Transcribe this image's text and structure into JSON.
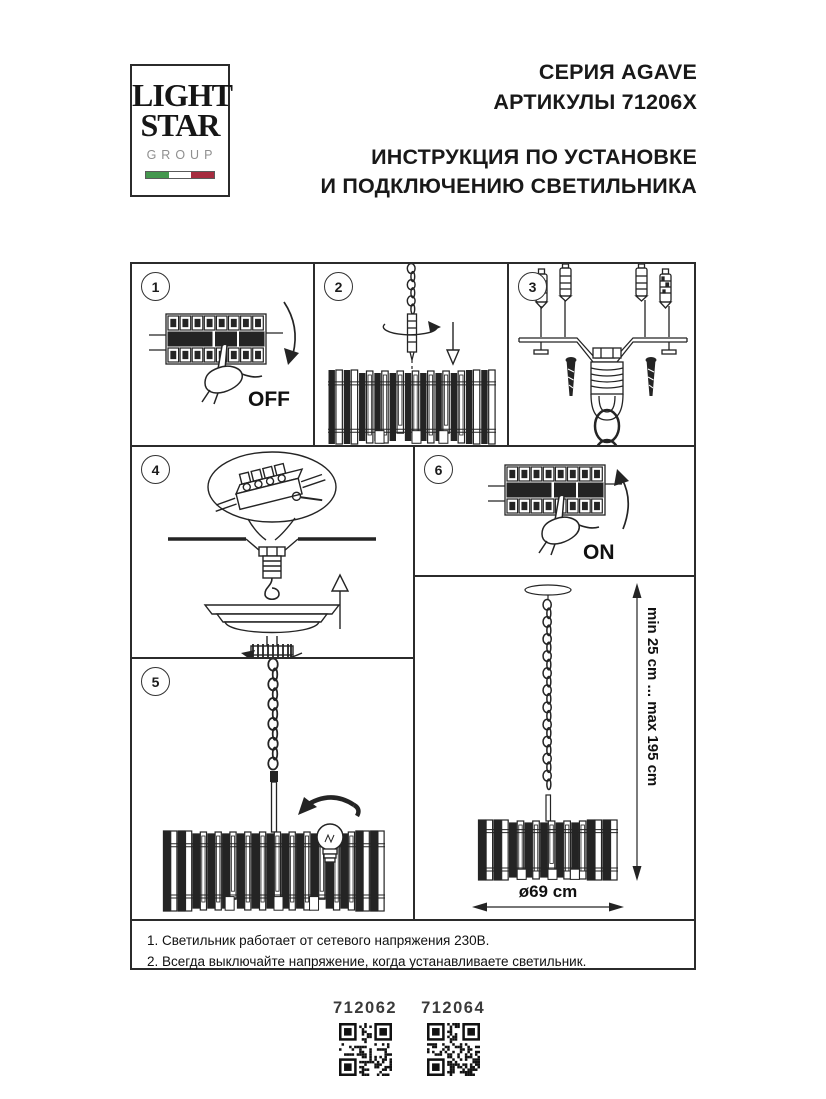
{
  "logo": {
    "line1": "LIGHT",
    "line2": "STAR",
    "line3": "GROUP"
  },
  "header": {
    "series": "СЕРИЯ AGAVE",
    "articles": "АРТИКУЛЫ 71206X",
    "title_line1": "ИНСТРУКЦИЯ ПО УСТАНОВКЕ",
    "title_line2": "И ПОДКЛЮЧЕНИЮ СВЕТИЛЬНИКА"
  },
  "steps": [
    {
      "number": "1",
      "label": "OFF"
    },
    {
      "number": "2",
      "label": ""
    },
    {
      "number": "3",
      "label": ""
    },
    {
      "number": "4",
      "label": ""
    },
    {
      "number": "5",
      "label": ""
    },
    {
      "number": "6",
      "label": "ON"
    }
  ],
  "dimensions": {
    "height_range": "min 25 cm ... max 195 cm",
    "diameter": "ø69 cm"
  },
  "notes": [
    "1. Светильник работает от сетевого напряжения 230В.",
    "2. Всегда выключайте напряжение, когда устанавливаете светильник."
  ],
  "footer": {
    "codes": [
      "712062",
      "712064"
    ]
  },
  "colors": {
    "ink": "#242424",
    "flag_green": "#44974e",
    "flag_red": "#a62c3f"
  }
}
